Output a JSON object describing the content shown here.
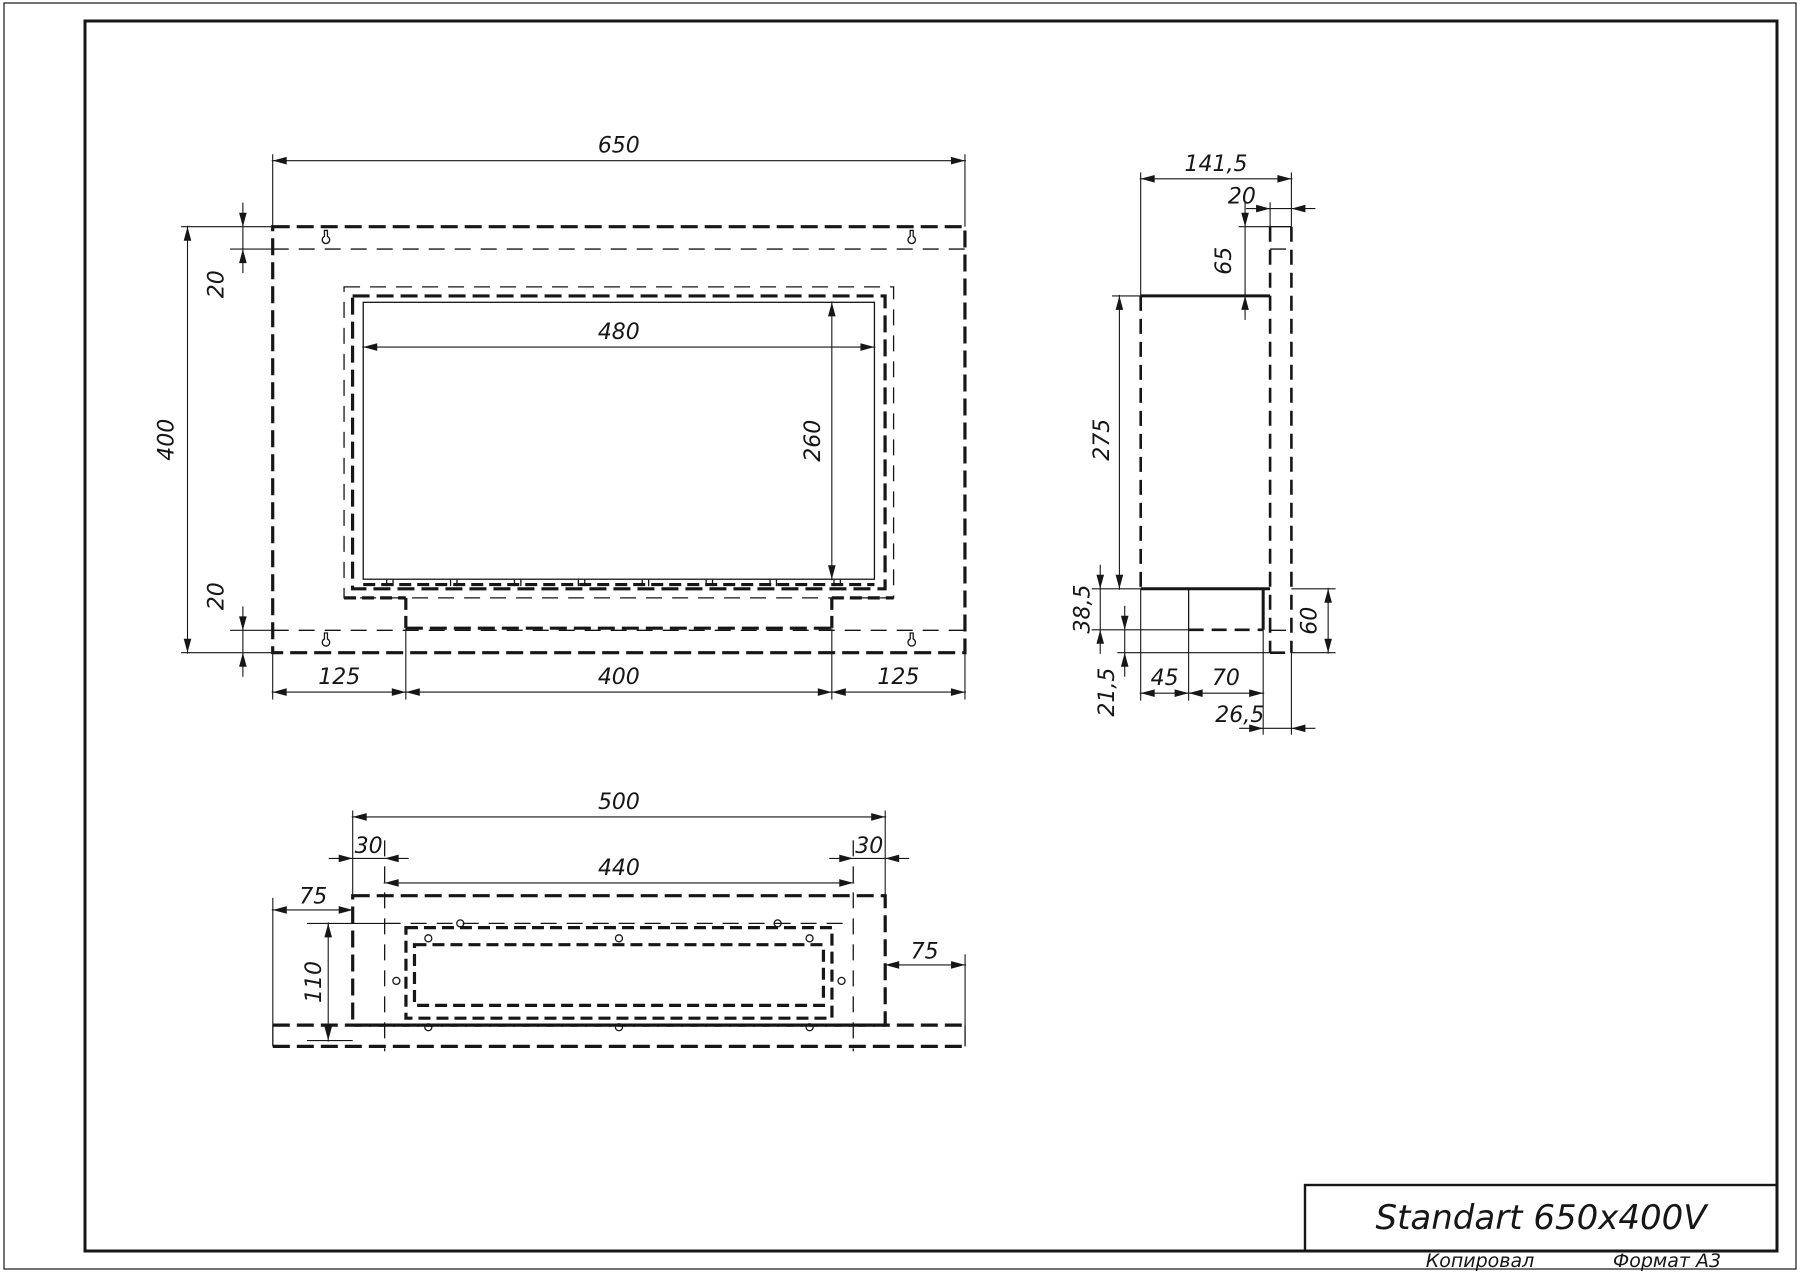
{
  "drawing": {
    "sheet_format": "A3",
    "views": [
      "front-view",
      "side-view",
      "bottom-view"
    ]
  },
  "front_view": {
    "dims": {
      "total_width": "650",
      "total_height": "400",
      "top_inset": "20",
      "bottom_inset": "20",
      "opening_width": "480",
      "opening_height": "260",
      "bottom_left_margin": "125",
      "burner_width": "400",
      "bottom_right_margin": "125"
    }
  },
  "side_view": {
    "dims": {
      "total_depth": "141,5",
      "flange_thickness": "20",
      "top_offset": "65",
      "body_height": "275",
      "burner_drop": "38,5",
      "flange_below": "21,5",
      "front_to_burner": "45",
      "burner_depth": "70",
      "burner_to_back": "26,5",
      "bottom_total": "60"
    }
  },
  "bottom_view": {
    "dims": {
      "body_width": "500",
      "left_inset": "30",
      "right_inset": "30",
      "inner_width": "440",
      "left_flange": "75",
      "right_flange": "75",
      "depth": "110"
    }
  },
  "title_block": {
    "title": "Standart 650x400V",
    "copied_label": "Копировал",
    "format_label": "Формат A3"
  },
  "colors": {
    "line": "#161616",
    "background": "#ffffff"
  }
}
